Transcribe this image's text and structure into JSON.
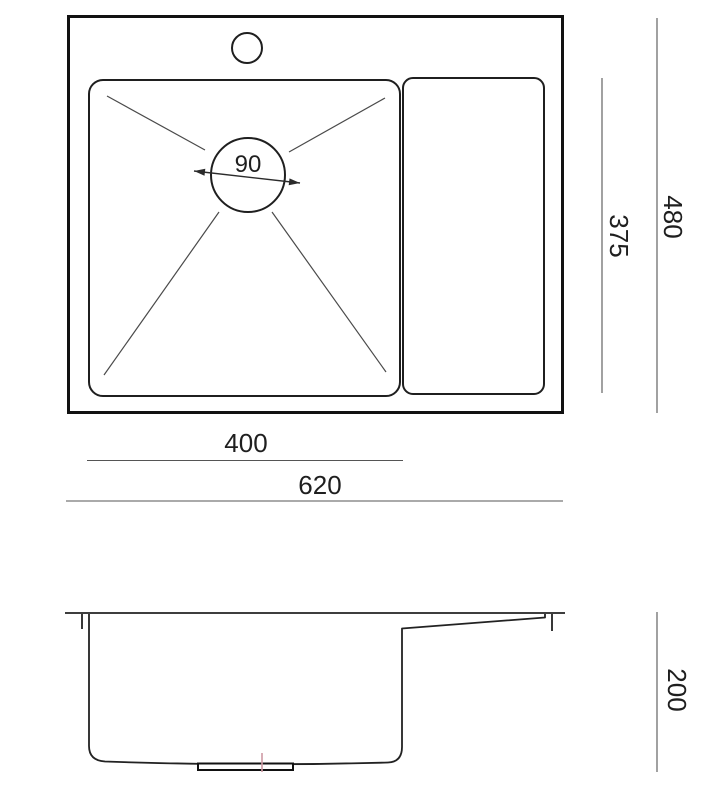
{
  "drawing": {
    "views": {
      "top_view_name": "sink-top-view",
      "side_view_name": "sink-side-profile-view"
    }
  },
  "dimensions": {
    "drain_diameter": "90",
    "inner_depth": "375",
    "overall_depth": "480",
    "bowl_width": "400",
    "overall_width": "620",
    "height": "200"
  },
  "colors": {
    "background": "#ffffff",
    "outline": "#1a1a1a",
    "dimension_line": "#555555",
    "drain_centerline": "#cf9aa4"
  }
}
